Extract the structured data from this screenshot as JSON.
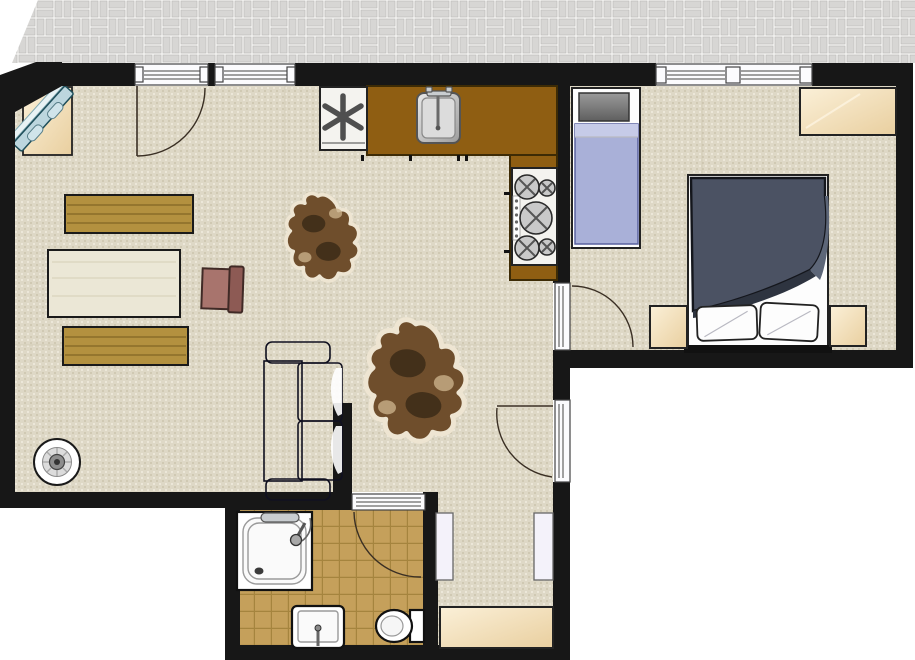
{
  "title": "Apartment floor plan",
  "plan": {
    "type": "floor-plan-drawing",
    "rooms": [
      "terrace",
      "living-room-open-kitchen",
      "bedroom",
      "bathroom",
      "hall"
    ],
    "openings": [
      "terrace-door",
      "living-window",
      "bedroom-window",
      "bedroom-door",
      "side-exit-door",
      "bathroom-door"
    ],
    "kitchen_items": [
      "asterisk-appliance",
      "kitchen-sink",
      "stove-five-burners",
      "l-shaped-counter"
    ],
    "living_items": [
      "corner-tv-cabinet",
      "bench-top",
      "coffee-table",
      "bench-bottom",
      "side-chair",
      "cowhide-rug-small",
      "cowhide-rug-large",
      "striped-sofa",
      "round-stool",
      "chimney-column"
    ],
    "bedroom_items": [
      "single-bed",
      "double-bed",
      "nightstand-left",
      "nightstand-right",
      "wardrobe"
    ],
    "bathroom_items": [
      "shower",
      "washbasin",
      "toilet"
    ],
    "hall_items": [
      "door-panel-left",
      "door-panel-right",
      "hall-cabinet"
    ]
  },
  "palette": {
    "wall": "#171717",
    "brick_bg": "#f4f3f1",
    "brick_fill": "#d7d6d4",
    "brick_line": "#b9b8b6",
    "carpet_base": "#ded8c6",
    "carpet_dot_dark": "#d0c9b3",
    "carpet_dot_light": "#ece7d9",
    "seam": "#c8c1ac",
    "tile_base": "#c5a05b",
    "tile_line": "#a5843e",
    "door_white": "#fbfbfd",
    "frame_line": "#444444",
    "arc_line": "#3a2f24",
    "counter": "#8f5e12",
    "counter_border": "#3d2b05",
    "appliance_white": "#f4f3ef",
    "asterisk": "#4f4f4f",
    "sofa_navy": "#2b2b68",
    "sofa_accent": "#9393c4",
    "bench_wood": "#b3913f",
    "bench_line": "#8a6d28",
    "table_wood": "#ebe7d6",
    "chair_seat": "#a8746d",
    "chair_back": "#8d5a54",
    "hide_brown": "#6f4e2c",
    "hide_dark": "#3c2b17",
    "hide_light": "#c9b089",
    "hide_edge": "#eee5d2",
    "duvet": "#4b5263",
    "duvet_fold": "#2e3440",
    "duvet_shadow": "#5d6678",
    "linen_white": "#fdfdfd",
    "blanket": "#a9b0d8",
    "blanket_fold": "#c6cbe8",
    "pillow_dark": "#5f5f5f",
    "pillow_light": "#9a9a9a",
    "beige_light": "#fbf0d8",
    "beige_dark": "#e9cf9f",
    "tv_screen": "#bcd6de",
    "tv_frame": "#1e4e5a"
  }
}
